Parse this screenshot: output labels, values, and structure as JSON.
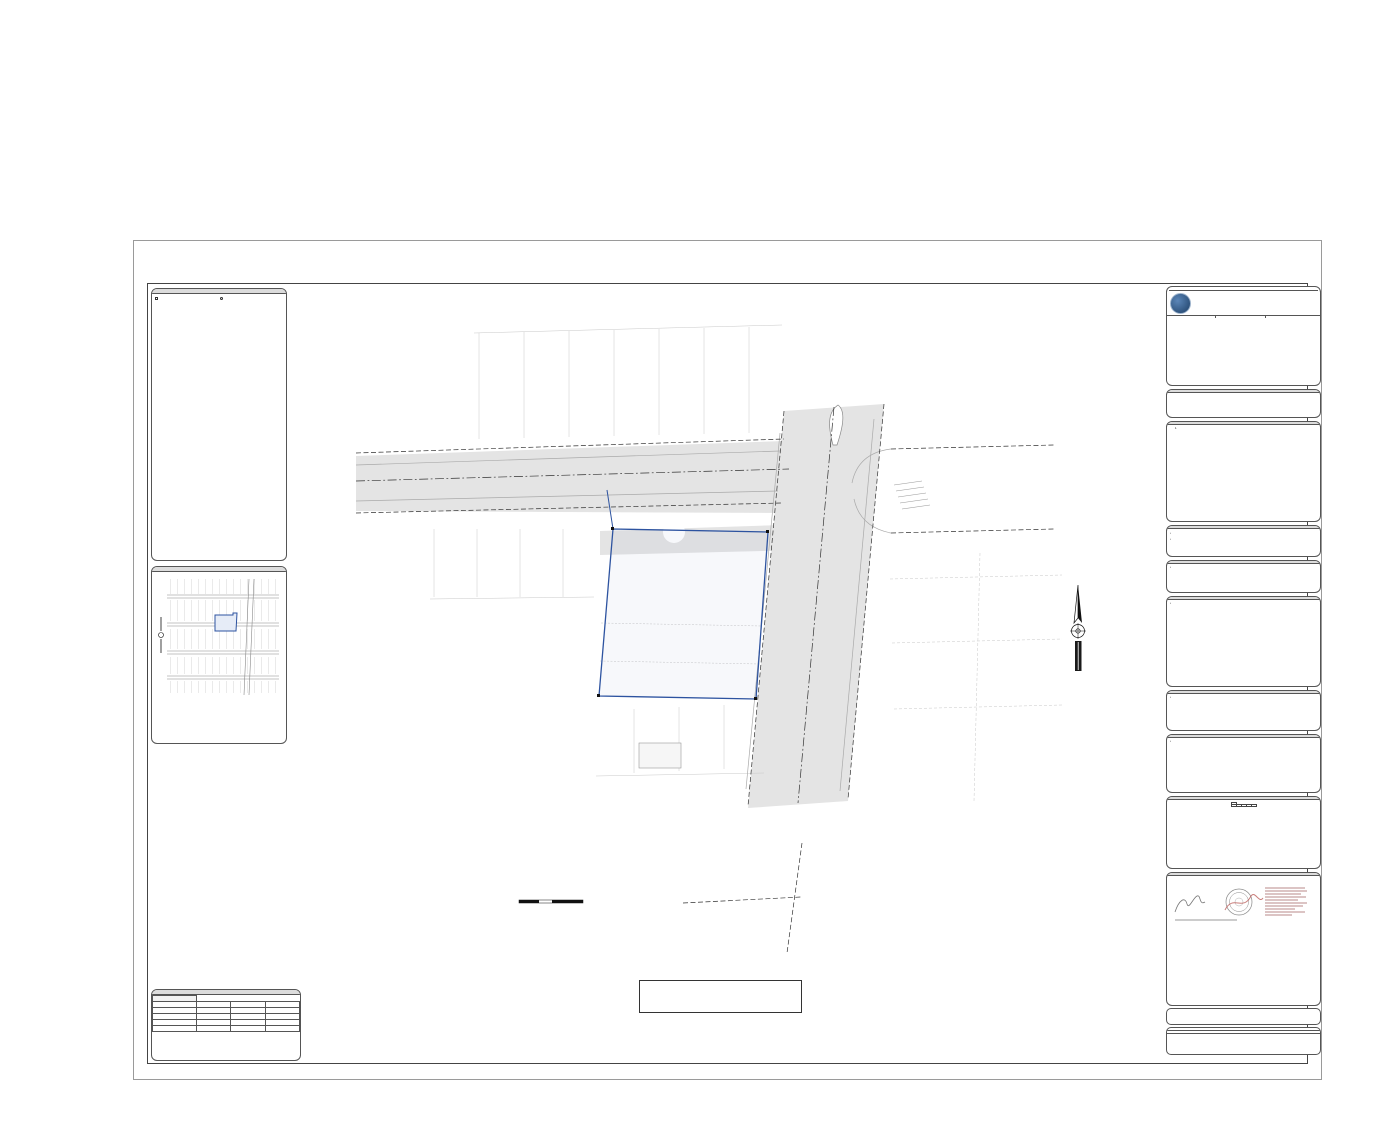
{
  "header": {
    "title": "5179 Broadway",
    "subtitle": "West Palm Beach, FL 33407",
    "section_heading": "Boundary and Topographic Survey"
  },
  "watermark": {
    "text": "A11733184 © Miami MLS® 2025"
  },
  "sheet": {
    "drawing": {
      "title1": "BOUNDARY AND TOPOGRAPHIC SURVEY",
      "sub1": "FIELD SURVEY WAS COMPLETED ON: AUGUST 28, 2023.",
      "sub2": "ELEVATION SHOWN HEREON REFER TO NORTH AMERICAN VERTICAL",
      "sub3": "DATUM OF 1988 (N.A.V.D. 1988) AND ARE EXPRESSED IN FEET",
      "st51_name": "51TH STREET",
      "st51_row": "(49.75' PUBLIC RIGHT OF WAY)",
      "st50_name": "50TH STREET",
      "broadway_name": "BROADWAY",
      "broadway_row": "(80.0' PUBLIC RIGHT OF WAY)",
      "bearing_cl": "S88°43'51\"E 130.04'(M&C)",
      "bearing_srw": "S88°43'51\"E 94.50' (R&M)",
      "bearing_w51": "N01°09'18\"E 24.97'(R&M)",
      "bearing_wp": "N01°24'19\"E 102.52'(R&M)",
      "bearing_s1": "N88°43'51\"W 93.86'(M&C)",
      "bearing_s2": "N88°43'51\"W 36.16'(R&M)",
      "set_nail": "SET NAIL",
      "set_nail_num": "LB#8062",
      "fnd_ir": "FND 1/2\" IR NO ID",
      "fnd_ip": "FND 1/2\" IP NO ID",
      "fnd_nail": "FND NAIL NO ID",
      "rw": "R/W",
      "less_a1": "LESS OUT 4.4' (R)",
      "less_a2": "LESS OUT 5.4' (R/W MAP)",
      "less_b1": "LESS OUT 4.4' (R)",
      "less_b2": "LESS OUT 6.1' (R/W MAP)",
      "ease1": "6.0' TEMPORARY EASEMENT",
      "ease2": "(O.R.B. 8214, PG. 1275)",
      "ease3": "(O.R.B. 11009, PG. 1800)",
      "ease4": "TERMINED DECEMBER 31, 2003.",
      "addr1": "#5179 BROADWAY",
      "addr2": "\"VACANT LAND\"",
      "addr3": "\"NOT BUILDING OBSERVED\"",
      "blk1": "NORTH PALM BEACH",
      "blk2": "BLOCK 56",
      "blk3": "(P.B. 5, PG. 71)",
      "blk4": "SUBJECT AREA",
      "blk5": "9,857 sq.ft.",
      "blk6": "0.226 Acres",
      "lot3": "LOT 3",
      "lot4": "LOT 4",
      "nb1": "NORTH PALM BEACH",
      "nb2": "BLOC 55",
      "nb3": "(P.B. 7, PG. 71)",
      "lot8": "LOT 8",
      "lot7": "LOT 7",
      "lot6": "LOT 6",
      "lot12": "LOT 12",
      "lot14": "LOT 14",
      "lot16": "LOT 16",
      "lot5": "LOT 5",
      "lot6b": "LOT 6",
      "bldg": "1 STORY C.B.S.",
      "dyl": "DOUBLE YELLOW LINE",
      "sw": "SIDEWALK",
      "cb1a": "DRAINAGE CATCH BASIN",
      "cb1b": "RIM = 14.27'",
      "cb1c": "INVERT NOT ACCESSIBLE",
      "cb2a": "DRAINAGE CATCH BASIN",
      "cb2b": "RIM = 14.31'",
      "cb2c": "NOT ACCESSIBLE",
      "cb2d": "FULL OF WATER",
      "mh1a": "DRAINAGE MANHOLE",
      "mh1b": "RIM = 15.23'",
      "mh1c": "INV.(S)=10.55' (18\" CONC)",
      "mh1d": "INV.(N)=10.40' (18\" CONC)",
      "mh2a": "SEWER MANHOLE",
      "mh2b": "RIM = 14.13'",
      "mh2c": "INV.(S)=8.32' (8\" CLAY)",
      "mh2d": "INV.(N)=8.11' (8\" CLAY)",
      "scale_title": "GRAPHIC SCALE",
      "scale_note": "1 INCH = 20 FEET",
      "s0": "0",
      "s10": "10",
      "s20": "20",
      "s40": "40",
      "north": "N",
      "datum1": "DATUM CONVERSION FACTOR:",
      "datum2": "N.G.V.D. 1929 = N.A.V.D. 1988 + 1.53'"
    },
    "legend": {
      "title": "LEGEND AND ABBREVIATIONS",
      "col1": [
        "CONCRETE POLE",
        "CONCRETE POWER POLE",
        "CONCRETE LIGHT POLE",
        "ALUMINUM POST",
        "ALUMINUM LIGHT POST",
        "WOOD POLE",
        "WOOD POWER POLE",
        "WOOD LIGHT POLE",
        "WATER BOX",
        "STREET LIGHT BOX",
        "PHONE BOX",
        "IRRIGATION BOX",
        "ELECTRIC BOX",
        "COMMUNICATION BOX",
        "CABLE T.V. BOX",
        "LANDSCAPE BOX",
        "TRAFFIC CONTROL BOX",
        "CLEANOUT",
        "BOLLARD",
        "FIRE HYD",
        "ANCHOR",
        "WATER METER",
        "IRRIGATION METER",
        "GAS METER",
        "ELECTRIC METER",
        "GUARD RAIL",
        "ROUND COLUMN",
        "MAIL BOX",
        "MONITORING WELL",
        "FLAG POLE",
        "GROUND LIGHT",
        "FLOOD LIGHT",
        "DRAINAGE WELL",
        "GRATE INLET",
        "CATCH BASIN",
        "CURB INLET",
        "CIRCULAR INLET",
        "STOP SIGN",
        "WOOD MANHOLE",
        "WALL MOUNT A/C",
        "TRAFFIC SIGNAL POLE",
        "TRAFFIC SIGN",
        "SURVEILLANCE CAMERA",
        "PEDESTRIAN CROSS SIGNAL"
      ],
      "col2": [
        "HANDICAP PARK MARK",
        "DEEP CIRCULAR PART MARK",
        "SANITARY MANHOLE",
        "WATER MANHOLE",
        "SEWER MANHOLE",
        "STORM MANHOLE",
        "IRRIGATION MANHOLE",
        "GREASE TRAP MANHOLE",
        "GAS MANHOLE",
        "PEDESTRIAN MANHOLE",
        "ELECTRICITY MANHOLE",
        "DRAINAGE MANHOLE",
        "COMMUNICATION MANHOLE",
        "WELL WATER MANHOLE",
        "PARKING METER",
        "PARKING SIGNS",
        "WATER VALVE",
        "SEWER VALVE",
        "IRRIGATION VALVE",
        "GAS VALVE",
        "CHECK WIRE VALVE",
        "VACUUM BREAKER ASSEMBLY",
        "REMOTE CONNECTION",
        "PROPERTY LINE",
        "CENTERLINE",
        "RIGHT OF WAY",
        "RADIUS",
        "DELTA ANGLE",
        "ARC DISTANCE",
        "PERMANENT CONTROL POINT",
        "PERMANENT REFERENCE MONUMENT",
        "FOUND IRON PIPE",
        "FOUND IRON ROD",
        "FOUND NAIL & DISC",
        "DRAINAGE EASEMENT",
        "UTILITY EASEMENT",
        "OFFICIAL RECORDS BOOK",
        "PLAT BOOK",
        "PAGE",
        "CONCRETE BLOCK STRUCTURE",
        "CHAIN LINK FENCE",
        "WOOD FENCE",
        "OVERHEAD UTILITY LINES",
        "EDGE OF PAVEMENT",
        "MEASURED / RECORD",
        "CALCULATED"
      ]
    },
    "location_map": {
      "title": "LOCATION MAP",
      "s52": "52TH ST",
      "s51": "51TH ST",
      "s50": "50TH ST",
      "s49": "49TH ST",
      "broadway": "BROADWAY",
      "subject1": "SUBJECT",
      "subject2": "AREA",
      "north": "N",
      "caption1": "A PORTION OF SECTION 09, TOWNSHIP 43 SOUTH, RANGE 43 EAST,",
      "caption2": "WEST PALM BEACH, PALM BEACH COUNTY, FLORIDA.",
      "caption3": "SCALE 1\"=300'"
    },
    "revisions": {
      "title": "REVISIONS",
      "headers": [
        "DATE",
        "JOB No",
        "REV",
        "BY"
      ],
      "rows": [
        {
          "date": "09/26/2023",
          "job": "153754",
          "rev": "ADD NAVD",
          "by": "C.A.F."
        },
        {
          "date": "02/12/2024",
          "job": "153754",
          "rev": "ADD DATUM CONVERSION FACTOR",
          "by": "C.A.F."
        }
      ]
    },
    "firm": {
      "title": "BOUNDARY AND TOPOGRAPHIC SURVEY",
      "prepared_for": "PREPARED FOR",
      "client": "RED OCTOPUS",
      "location1": "LYING AND BEING IN SECTION 09, TOWNSHIP 43 SOUTH, RANGE 43 EAST",
      "location2": "WEST PALM BEACH, PALM BEACH COUNTY, FLORIDA.",
      "logo_text": "JHA",
      "name": "J.Hernandez & Associates Inc",
      "tagline": "LAND SURVEYORS AND MAPPERS",
      "cert": "CERTIFICATE OF AUTHORIZATION No. LB8062",
      "address": "3300 NW 112th AVE, SUITE #10, MIAMI, FL 33172",
      "phone": "(P) 305-529-0606 (E) info@jhsurveys.com",
      "drawn_by": "DRAWN BY: C.A.F.",
      "drawn_date": "DATE: 08/09/23",
      "checked_by": "CHECKED BY: J.G.H.",
      "checked_date": "DATE: 08/30/23",
      "job_num": "JOB NUM: 153754",
      "fb": "F.B. NC-17, PG. 03"
    },
    "legal": {
      "title": "LEGAL DESCRIPTION",
      "body": "LOTS 1, 2, 3 AND 4, BLOCK 56, NORTH PALM BEACH PLAN NO. 4, ACCORDING TO THE MAP THEREOF AS RECORDED IN PLAT BOOK 5, PAGE 71, PUBLIC RECORDS OF PALM BEACH COUNTY, FLORIDA."
    },
    "notes": {
      "title": "SURVEYOR'S NOTES",
      "items": [
        "FIELD SURVEY WAS COMPLETED ON: AUGUST 28, 2023.",
        "SUBJECT PROPERTY AREA: 9,857 ± Sq.Ft. (0.226 ACRES).",
        "BEARINGS BASED ON AN ASSUMED BEARING OF S88°43'51\"E ALONG THE CENTER LINE OF 51st STREET.",
        "LEGAL DESCRIPTION WAS PROVIDED BY THE CLIENT.",
        "DISTANCES ALONG BOUNDARY LINES, AS SHOWN HEREON, ARE RECORD AND/OR MEASURED UNLESS OTHERWISE NOTED.",
        "INTERIOR LOT LINES, AS SHOWN HEREON, ARE FOR INFORMATIONAL PURPOSE ONLY, UNLESS OTHERWISE NOTED.",
        "UNDERGROUND FOOTINGS, FOUNDATIONS AND UTILITIES HAVE NOT BEEN LOCATED AT THE TIME OF THIS SURVEY, UNLESS OTHERWISE NOTED.",
        "ABOVEGROUND AND/OR VISIBLE UTILITIES HAVE NOT BEEN LOCATED AT THE TIME OF THIS SURVEY, UNLESS OTHERWISE NOTED.",
        "SUBJECT PROPERTY HAS A DIRECT PHYSICAL ACCESS TO AND FROM 51st STREET, A PUBLIC DEDICATED RIGHT-OF-WAY.",
        "THIS BOUNDARY SURVEY IS SUBJECT TO EASEMENTS, RIGHTS-OF-WAY AND OTHER MATTERS THAT MIGHT BE REFLECTED ON A SEARCH OF TITLE OF THE SUBJECT PROPERTY."
      ]
    },
    "property": {
      "title": "PROPERTY INFORMATION",
      "address_label": "PROPERTY ADDRESS:",
      "address1": "5179 BROADWAY",
      "address2": "PALM BEACH, FLORIDA, 33407",
      "folio_label": "FOLIO NUMBER:",
      "folio": "74-43-43-09-08-056-0010"
    },
    "certify": {
      "title": "CERTIFY TO:",
      "items": [
        "RED OCTOPUS"
      ]
    },
    "datum": {
      "title": "DATUM AND BENCHMARKS",
      "items": [
        "ELEVATIONS SHOWN HEREON REFER TO NORTH AMERICAN VERTICAL DATUM OF 1988 (N.A.V.D. 1988) AND ARE EXPRESSED IN FEET.",
        "BENCHMARK: PALM BEACH P 222 RESET. ELEVATION: 13.29' N.A.V.D. DESCRIPTION: IN WEST PALM BEACH, AT THE INTERSECTION OF THE FLORIDA EAST COAST RAILROAD AND 54th STREET, 15.5 M (50.9 FT) NORTH OF THE STREET CENTERLINE, 19.8 M (49.8 FT) EAST OF THE NEAR RAIL, 4.4 M (14.4 FT) SOUTH OF CHAIN-LINK FENCE CORNER, 1.0 M (3.3 FT) BELOW THE LEVEL OF THE TRACK, AND THE MONUMENT IS RECESSED 0.1 M (0.3 FT) BELOW THE GROUND SURFACE AND 16 FEET SOUTH OF A METAL WITNESS SIGN ATTACHED TO A VERTICALLY SET CONCRETE RAILROAD TIE."
      ]
    },
    "flood": {
      "title": "FLOOD ZONE INFORMATION",
      "items": [
        "SUBJECT PROPERTY IS LOCATED WITHIN FLOOD ZONE \"X\", AS SHOWN ON FLOOD INSURANCE RATE MAP NUMBER 12099C0393F, DATED: OCTOBER 5, 2017.",
        "ELEVATION REFER TO NORTH AMERICAN VERTICAL DATUM OF 1988 AND IS EXPRESSED IN FEET."
      ]
    },
    "encroachments": {
      "title": "POSSIBLE ENCROACHMENTS",
      "items": [
        "A PORTION OF WOOD FENCE, ALONG THE WEST BOUNDARY LINE, ENCROACH 0.6' FROM ADJOINING LANDS, ONTO SUBJECT PROPERTY.",
        "SIDEWALK ALONG THE EAST BOUNDARY LINE, ENCROACH 1.0' FROM RIGHT OF WAY ONTO SUBJECT PROPERTY.",
        "THERE ARE NOT, ADDITIONAL, OBSERVED, ENCROACHMENTS ONTO THE SUBJECT PROPERTY FROM ADJOINING LANDS, OR FROM THE SUBJECT PROPERTY ONTO ADJOINING LANDS, UNLESS OTHERWISE NOTED."
      ]
    },
    "tree": {
      "title": "TREE TABULATION",
      "headers": [
        "TREE NO",
        "COMMON NAME",
        "DIA. IN.",
        "HT. FT.",
        "CNPY. Ø FT."
      ],
      "rows": [
        [
          "1",
          "PALM",
          "10",
          "8",
          "6"
        ]
      ],
      "note1": "TREE IDENTIFICATION MUST BE",
      "note2": "VERIFY BY A CERTIFIED SPECIALIST"
    },
    "certification": {
      "title": "SURVEYOR'S CERTIFICATION",
      "body": "I HEREBY CERTIFY THAT THIS \"BOUNDARY AND TOPOGRAPHIC SURVEY\" OF THE PROPERTY DESCRIBED HEREON IS TRUE AND CORRECT TO THE BEST OF MY KNOWLEDGE AND BELIEF AS RECENTLY SURVEYED AND DRAWN UNDER MY SUPERVISION AND DIRECTION. THIS SURVEY COMPLIES WITH STANDARDS OF PRACTICE REQUIREMENTS ADOPTED BY THE FLORIDA STATE BOARD OF SURVEYORS AND MAPPERS PURSUANT TO CHAPTER 5J-17, FLORIDA ADMINISTRATIVE CODE.",
      "body2": "THIS CERTIFICATION DOES NOT EXTEND TO ANY UNNAMED PARTIES.",
      "by_label": "BY:",
      "signer1": "JOSE G. HERNANDEZ, PRESIDENT",
      "signer2": "PROFESSIONAL LAND SURVEYOR No. 6963",
      "signer3": "STATE OF FLORIDA.",
      "seal_note": "THE ELECTRONIC SEAL AND SIGNATURE APPEARING ON THIS SURVEY WAS AUTHORIZED BY: JOSE G. HERNANDEZ, PROFESSIONAL LAND SURVEYOR No. 6963 OF THE STATE OF FLORIDA ON: FEBRUARY 28, 2024."
    },
    "footer": {
      "line1": "THIS IS A BOUNDARY SURVEY",
      "line2": "PROJECT NUMBER: PB-123",
      "line3": "SHEET NUMBER: 1 OF 1"
    }
  }
}
